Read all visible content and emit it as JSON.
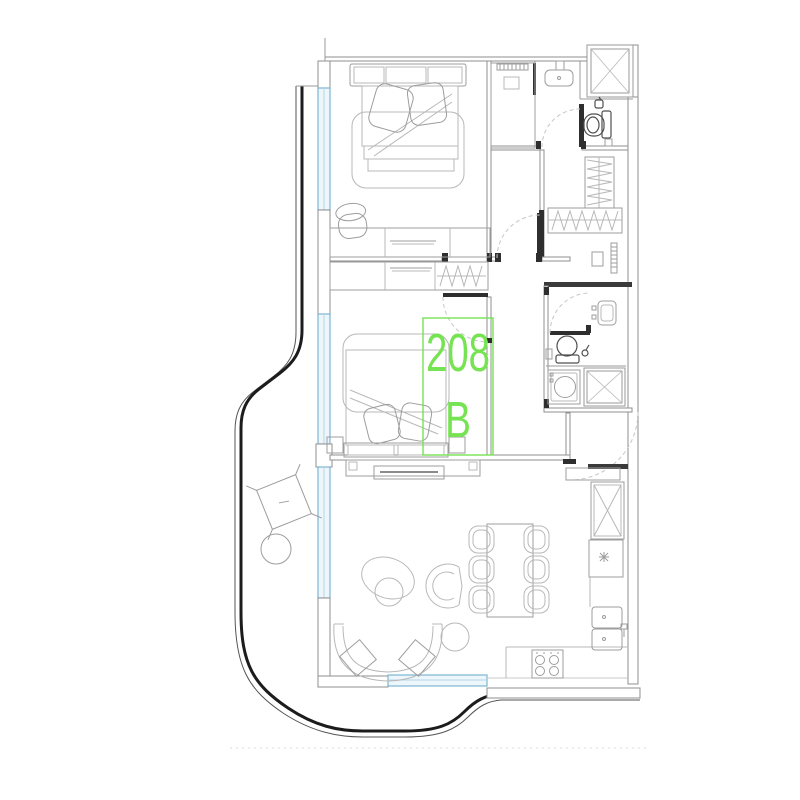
{
  "unit": {
    "number": "208",
    "section": "B"
  },
  "colors": {
    "label_green": "#76e352",
    "window_blue": "#7db6d2",
    "window_fill": "#edf6fa",
    "wall_gray": "#8f8f8f",
    "outline_dark": "#1c1c1c"
  }
}
